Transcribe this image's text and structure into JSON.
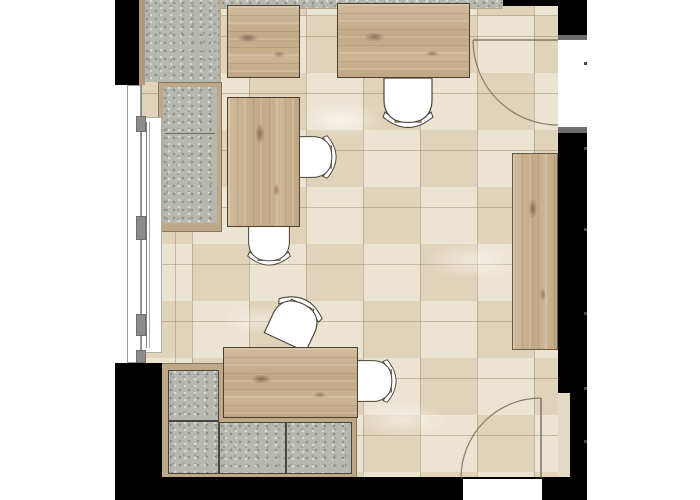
{
  "meta": {
    "description": "Top-down architectural floor plan of a furnished office room",
    "canvas": {
      "width": 700,
      "height": 500
    }
  },
  "palette": {
    "page_background": "#ffffff",
    "wall": "#000000",
    "floor_tile": "#e7dcc6",
    "floor_tile_alt": "#d6c9ae",
    "tile_grout": "#a08c66",
    "desk_wood": "#c8b091",
    "desk_outline": "#4f3f2b",
    "sideboard_wood": "#cfc0a5",
    "cabinet_granite": "#b6b7af",
    "cabinet_frame_tan": "#bda888",
    "chair_fill": "#ffffff",
    "chair_outline": "#4c4438",
    "door_swing_line": "#877b66",
    "door_jamb_cap": "#6d6d6d",
    "window_frame": "#9a9a9a",
    "window_joint": "#8d8d8d"
  },
  "objects": {
    "desks": [
      {
        "id": "desk-top-left",
        "kind": "desk",
        "material": "wood"
      },
      {
        "id": "desk-top-right",
        "kind": "desk",
        "material": "wood"
      },
      {
        "id": "desk-middle-left",
        "kind": "desk",
        "material": "wood"
      },
      {
        "id": "desk-bottom",
        "kind": "desk",
        "material": "wood"
      }
    ],
    "sideboard": {
      "id": "sideboard-right-wall",
      "kind": "board",
      "material": "wood"
    },
    "cabinets": [
      {
        "id": "cabinet-run-left",
        "finish": "granite-speckle"
      },
      {
        "id": "counter-strip-top",
        "finish": "granite-speckle"
      },
      {
        "id": "cabinet-block-bottom-left",
        "finish": "granite-speckle",
        "sections": 4
      }
    ],
    "chairs": [
      {
        "id": "chair-at-desk-top-right",
        "kind": "office-chair"
      },
      {
        "id": "chair-right-of-desk-middle",
        "kind": "office-chair"
      },
      {
        "id": "chair-below-desk-middle",
        "kind": "office-chair"
      },
      {
        "id": "chair-above-desk-bottom",
        "kind": "office-chair"
      },
      {
        "id": "chair-right-of-desk-bottom",
        "kind": "office-chair"
      }
    ],
    "doors": [
      {
        "id": "door-right-top",
        "type": "swing-door",
        "swing": "quarter-arc-into-room"
      },
      {
        "id": "door-bottom",
        "type": "swing-door",
        "swing": "quarter-arc-into-room"
      }
    ],
    "windows": [
      {
        "id": "window-left-wall",
        "type": "mullioned-window",
        "joints": 4
      }
    ]
  }
}
